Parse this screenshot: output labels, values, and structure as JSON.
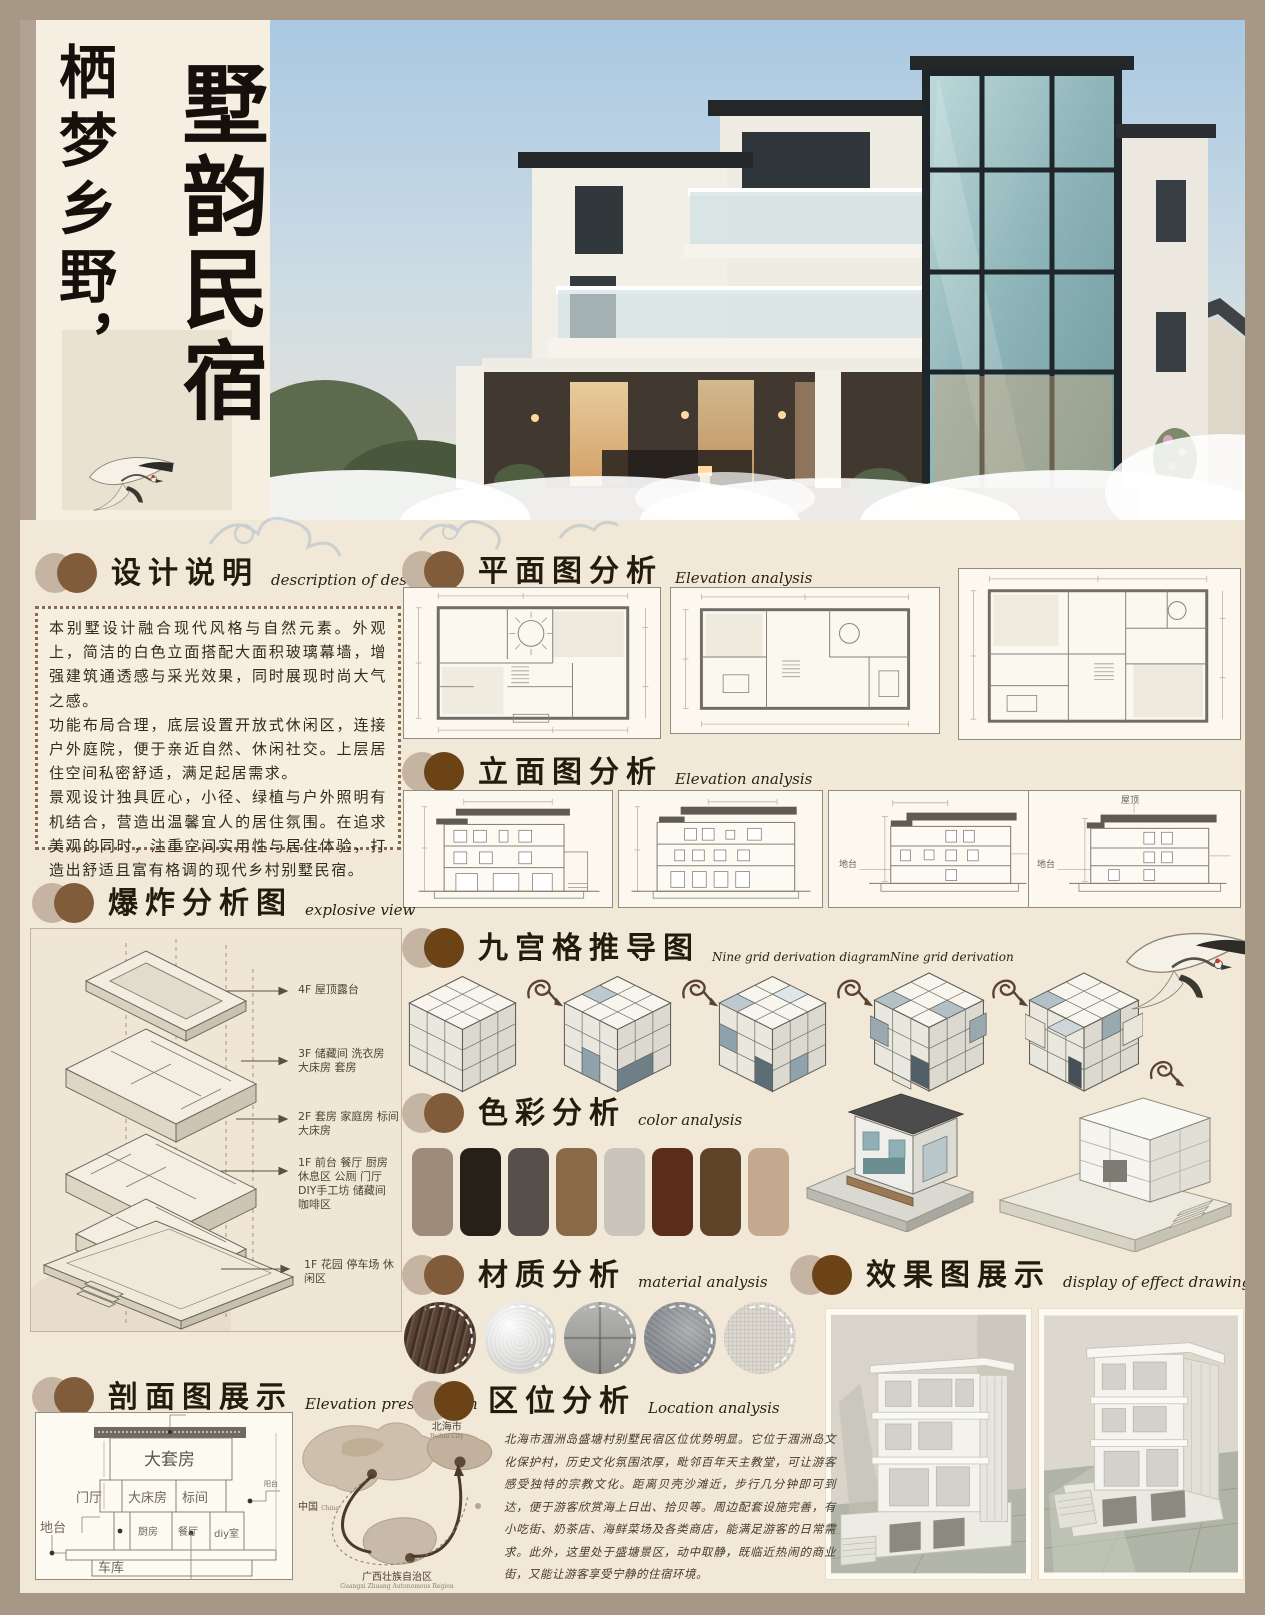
{
  "page": {
    "title_left": "栖梦乡野，",
    "title_right": "墅韵民宿"
  },
  "accents": {
    "board_bg": "#f2e8d8",
    "frame_bg": "#a69884",
    "header_circle_light": "#c6b4a3",
    "header_circle_brown": "#805c3b",
    "ink": "#241a0e"
  },
  "sections": {
    "design": {
      "title": "设计说明",
      "en": "description of design",
      "body": [
        "本别墅设计融合现代风格与自然元素。外观上，简洁的白色立面搭配大面积玻璃幕墙，增强建筑通透感与采光效果，同时展现时尚大气之感。",
        "功能布局合理，底层设置开放式休闲区，连接户外庭院，便于亲近自然、休闲社交。上层居住空间私密舒适，满足起居需求。",
        "景观设计独具匠心，小径、绿植与户外照明有机结合，营造出温馨宜人的居住氛围。在追求美观的同时，注重空间实用性与居住体验，打造出舒适且富有格调的现代乡村别墅民宿。"
      ]
    },
    "plan": {
      "title": "平面图分析",
      "en": "Elevation analysis"
    },
    "elevation": {
      "title": "立面图分析",
      "en": "Elevation analysis",
      "roof_label": "屋顶",
      "platform_label": "地台"
    },
    "explosive": {
      "title": "爆炸分析图",
      "en": "explosive view",
      "labels": [
        "4F 屋顶露台",
        "3F 储藏间 洗衣房 大床房 套房",
        "2F 套房 家庭房 标间 大床房",
        "1F 前台 餐厅 厨房 休息区 公厕 门厅 DIY手工坊 储藏间 咖啡区",
        "1F 花园 停车场 休闲区"
      ]
    },
    "nine": {
      "title": "九宫格推导图",
      "en": "Nine grid derivation diagramNine grid derivation"
    },
    "color": {
      "title": "色彩分析",
      "en": "color analysis",
      "palette": [
        "#9c8c79",
        "#262019",
        "#57504a",
        "#8a6946",
        "#cac5bc",
        "#5a2d1a",
        "#5e4326",
        "#c3a98d"
      ]
    },
    "material": {
      "title": "材质分析",
      "en": "material analysis",
      "items": [
        {
          "name": "dark-wood",
          "color": "#5a4334"
        },
        {
          "name": "silver-fabric",
          "color": "#d9d9d7"
        },
        {
          "name": "stone-tile",
          "color": "#a6a6a2"
        },
        {
          "name": "concrete",
          "color": "#8e9296"
        },
        {
          "name": "plaster",
          "color": "#dcd8d0"
        }
      ]
    },
    "effect": {
      "title": "效果图展示",
      "en": "display of effect drawing"
    },
    "section_view": {
      "title": "剖面图展示",
      "en": "Elevation presentation",
      "rooms": {
        "suite": "大套房",
        "double": "大床房",
        "standard": "标间",
        "foyer": "门厅",
        "kitchen": "厨房",
        "dining": "餐厅",
        "diy": "diy室",
        "platform": "地台",
        "garage": "车库",
        "balcony": "阳台"
      }
    },
    "location": {
      "title": "区位分析",
      "en": "Location analysis",
      "body": "北海市涠洲岛盛塘村别墅民宿区位优势明显。它位于涠洲岛文化保护村，历史文化氛围浓厚，毗邻百年天主教堂，可让游客感受独特的宗教文化。距离贝壳沙滩近，步行几分钟即可到达，便于游客欣赏海上日出、拾贝等。周边配套设施完善，有小吃街、奶茶店、海鲜菜场及各类商店，能满足游客的日常需求。此外，这里处于盛塘景区，动中取静，既临近热闹的商业街，又能让游客享受宁静的住宿环境。",
      "map": {
        "china": "中国",
        "china_en": "China",
        "beihai": "北海市",
        "beihai_en": "Beihai City",
        "guangxi": "广西壮族自治区",
        "guangxi_en": "Guangxi Zhuang Autonomous Region"
      }
    }
  }
}
